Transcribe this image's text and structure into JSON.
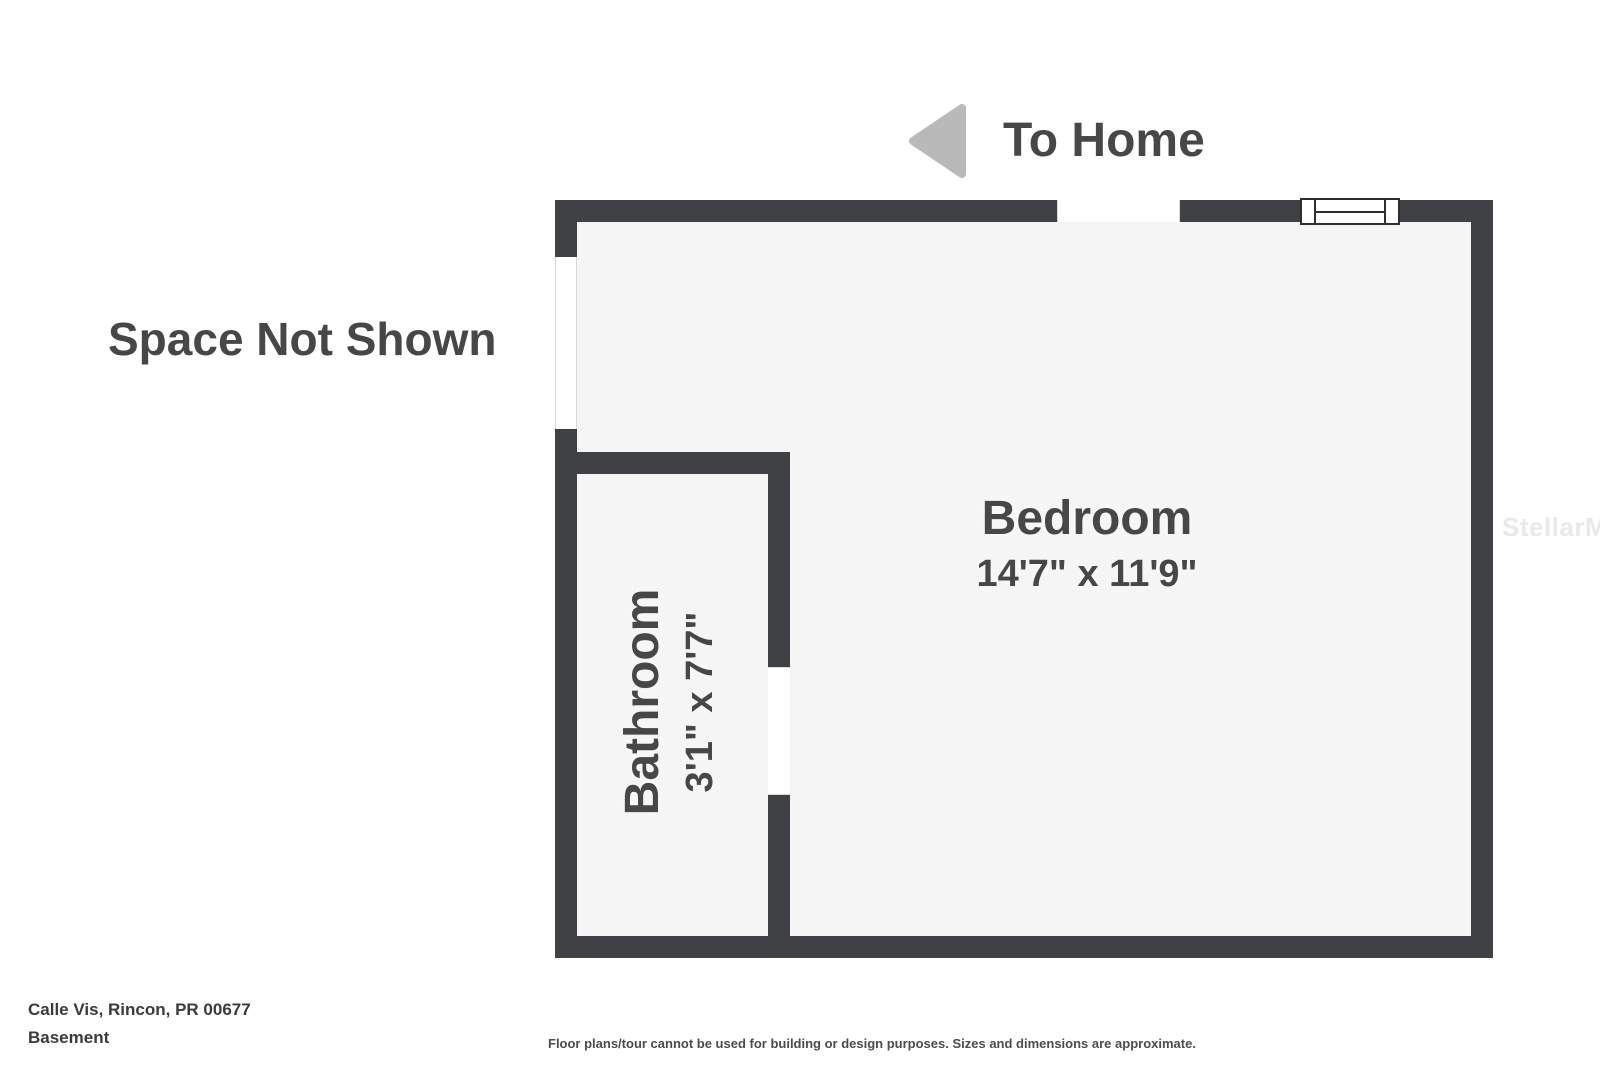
{
  "nav": {
    "to_home_label": "To Home"
  },
  "plan": {
    "space_not_shown_label": "Space Not Shown",
    "rooms": [
      {
        "name": "Bedroom",
        "dimensions": "14'7\" x 11'9\""
      },
      {
        "name": "Bathroom",
        "dimensions": "3'1\" x 7'7\""
      }
    ]
  },
  "footer": {
    "address": "Calle Vis, Rincon, PR 00677",
    "floor_label": "Basement",
    "disclaimer": "Floor plans/tour cannot be used for building or design purposes. Sizes and dimensions are approximate."
  },
  "watermark": "StellarMLS",
  "colors": {
    "wall": "#3f4144",
    "floor": "#f5f5f6",
    "label_text": "#474747",
    "arrow": "#b9b9b9",
    "watermark": "#e9e9e9"
  }
}
